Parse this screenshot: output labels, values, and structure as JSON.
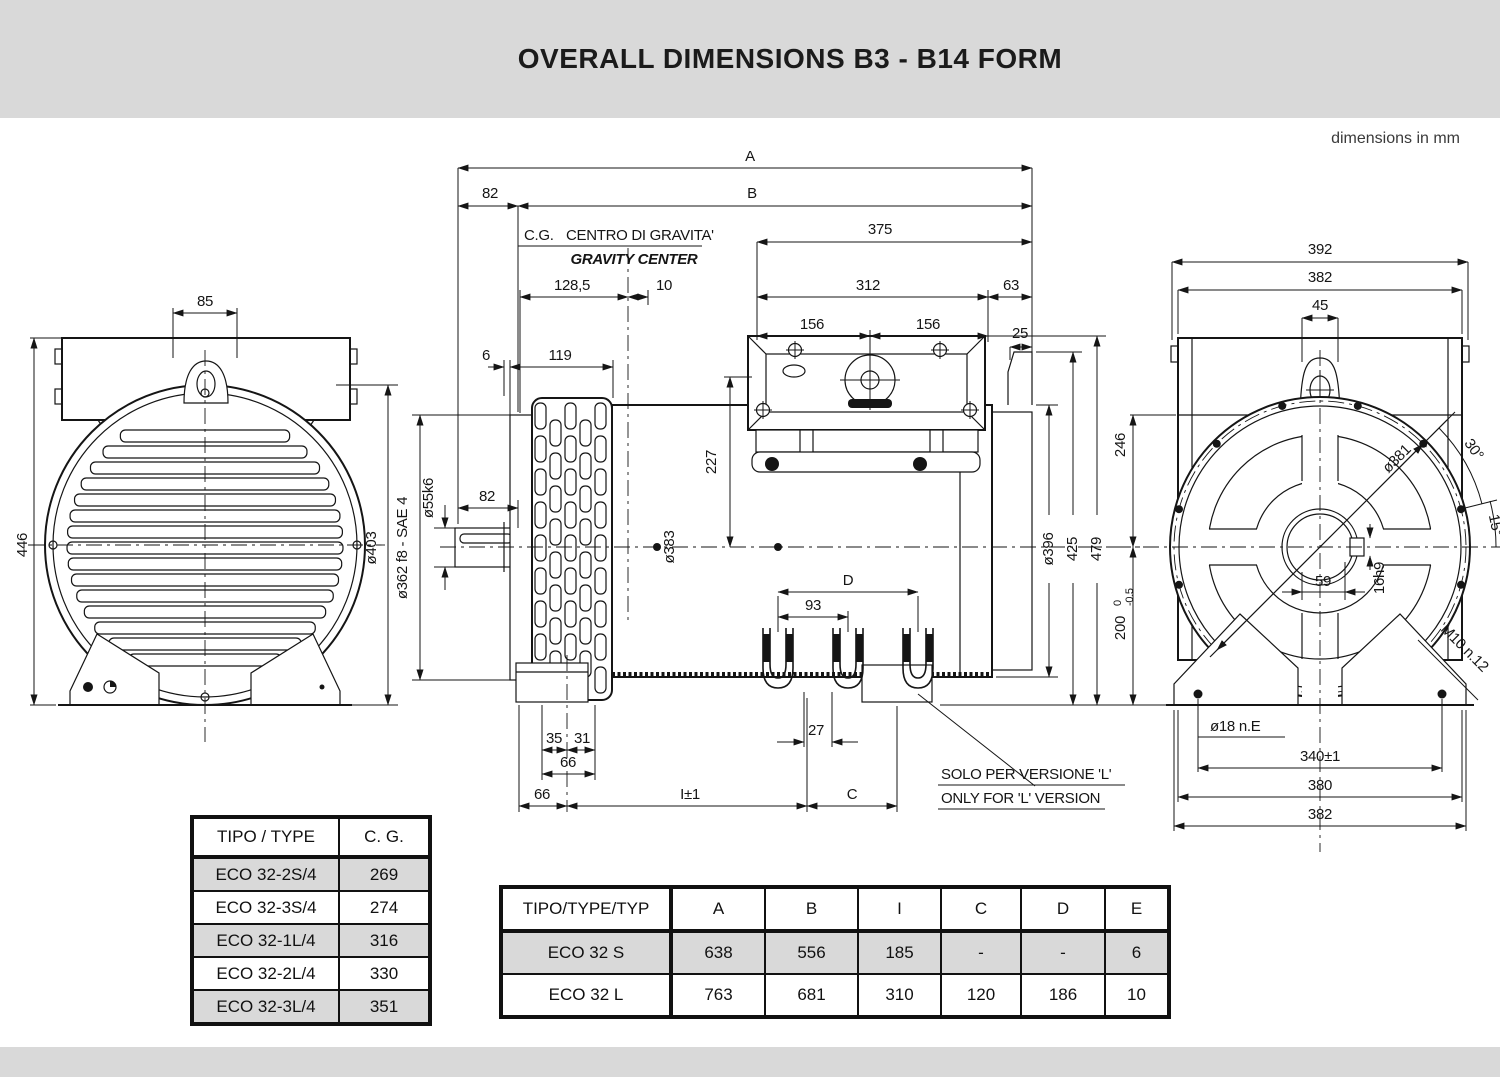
{
  "header": {
    "title": "OVERALL DIMENSIONS B3 - B14 FORM",
    "units_note": "dimensions in mm"
  },
  "colors": {
    "band_gray": "#d9d9d9",
    "row_gray": "#d9d9d9",
    "ink": "#151515"
  },
  "views": {
    "front": {
      "dim_85": "85",
      "dim_446": "446"
    },
    "side": {
      "dim_a": "A",
      "dim_b": "B",
      "dim_82_left": "82",
      "cg_abbr": "C.G.",
      "cg_it": "CENTRO DI GRAVITA'",
      "cg_en": "GRAVITY CENTER",
      "dim_128_5": "128,5",
      "dim_10": "10",
      "dim_375": "375",
      "dim_312": "312",
      "dim_63": "63",
      "dim_156_a": "156",
      "dim_156_b": "156",
      "dim_25": "25",
      "dim_6": "6",
      "dim_119": "119",
      "dim_227": "227",
      "dim_shaft": "ø55k6",
      "dim_82_shaft": "82",
      "dim_flange": "ø362 f8 - SAE 4",
      "dim_403": "ø403",
      "dim_383": "ø383",
      "dim_396": "ø396",
      "dim_425": "425",
      "dim_479": "479",
      "dim_d": "D",
      "dim_93": "93",
      "dim_27": "27",
      "dim_35": "35",
      "dim_31": "31",
      "dim_66_a": "66",
      "dim_66_b": "66",
      "dim_i": "I±1",
      "dim_c": "C",
      "note_it": "SOLO PER VERSIONE 'L'",
      "note_en": "ONLY FOR 'L' VERSION"
    },
    "rear": {
      "dim_392": "392",
      "dim_382_top": "382",
      "dim_45": "45",
      "dim_246": "246",
      "dim_200": "200",
      "tol_hi": "0",
      "tol_lo": "-0.5",
      "dim_381": "ø381",
      "dim_30": "30°",
      "dim_15": "15°",
      "dim_59": "59",
      "dim_16h9": "16h9",
      "dim_m10": "M10 n.12",
      "dim_18": "ø18 n.E",
      "dim_340": "340±1",
      "dim_380": "380",
      "dim_382_bottom": "382"
    }
  },
  "cg_table": {
    "headers": [
      "TIPO / TYPE",
      "C. G."
    ],
    "rows": [
      [
        "ECO 32-2S/4",
        "269"
      ],
      [
        "ECO 32-3S/4",
        "274"
      ],
      [
        "ECO 32-1L/4",
        "316"
      ],
      [
        "ECO 32-2L/4",
        "330"
      ],
      [
        "ECO 32-3L/4",
        "351"
      ]
    ]
  },
  "dim_table": {
    "headers": [
      "TIPO/TYPE/TYP",
      "A",
      "B",
      "I",
      "C",
      "D",
      "E"
    ],
    "rows": [
      [
        "ECO 32 S",
        "638",
        "556",
        "185",
        "-",
        "-",
        "6"
      ],
      [
        "ECO 32 L",
        "763",
        "681",
        "310",
        "120",
        "186",
        "10"
      ]
    ]
  }
}
